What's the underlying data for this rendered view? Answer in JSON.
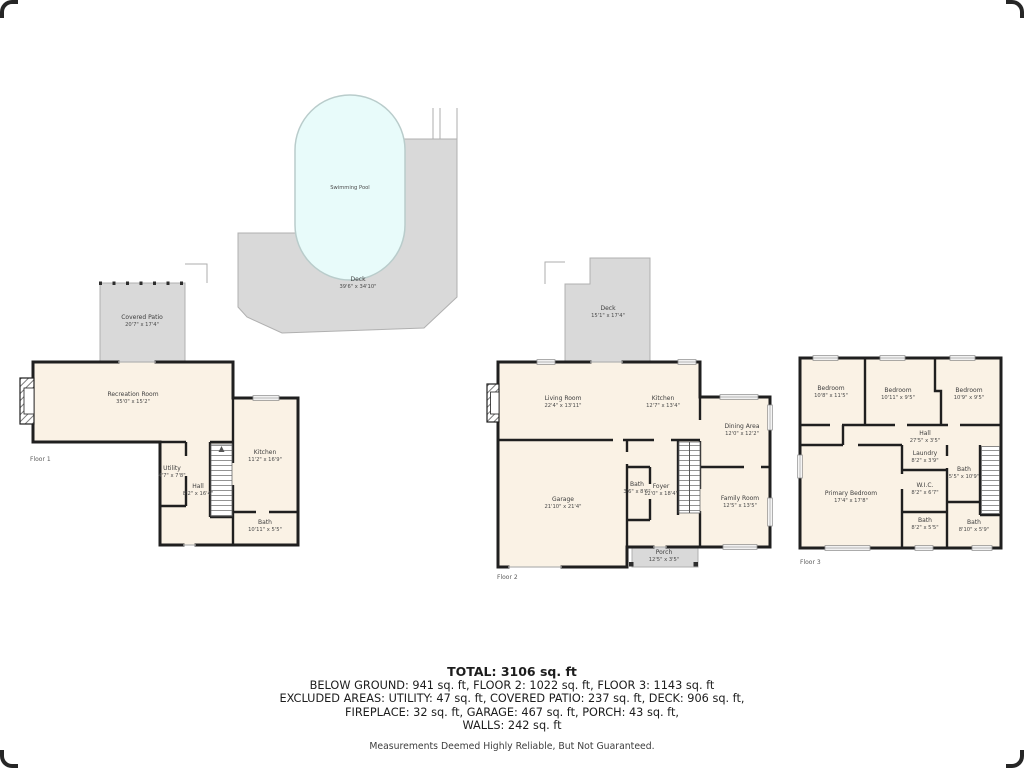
{
  "pool_area": {
    "pool": {
      "label": "Swimming Pool"
    },
    "pool_deck": {
      "name": "Deck",
      "dims": "39'6\" x 34'10\""
    },
    "covered_patio": {
      "name": "Covered Patio",
      "dims": "20'7\" x 17'4\""
    }
  },
  "floor1": {
    "label": "Floor 1",
    "rooms": {
      "recreation_room": {
        "name": "Recreation Room",
        "dims": "35'0\" x 15'2\""
      },
      "utility": {
        "name": "Utility",
        "dims": "4'7\" x 7'8\""
      },
      "hall": {
        "name": "Hall",
        "dims": "8'2\" x 16'4\""
      },
      "kitchen": {
        "name": "Kitchen",
        "dims": "11'2\" x 16'9\""
      },
      "bath": {
        "name": "Bath",
        "dims": "10'11\" x 5'5\""
      }
    }
  },
  "floor2": {
    "label": "Floor 2",
    "rooms": {
      "deck": {
        "name": "Deck",
        "dims": "15'1\" x 17'4\""
      },
      "living_room": {
        "name": "Living Room",
        "dims": "22'4\" x 13'11\""
      },
      "kitchen": {
        "name": "Kitchen",
        "dims": "12'7\" x 13'4\""
      },
      "dining_area": {
        "name": "Dining Area",
        "dims": "12'0\" x 12'2\""
      },
      "garage": {
        "name": "Garage",
        "dims": "21'10\" x 21'4\""
      },
      "bath": {
        "name": "Bath",
        "dims": "3'6\" x 8'6\""
      },
      "foyer": {
        "name": "Foyer",
        "dims": "12'0\" x 18'4\""
      },
      "family_room": {
        "name": "Family Room",
        "dims": "12'5\" x 13'5\""
      },
      "porch": {
        "name": "Porch",
        "dims": "12'5\" x 3'5\""
      }
    }
  },
  "floor3": {
    "label": "Floor 3",
    "rooms": {
      "bedroom_1": {
        "name": "Bedroom",
        "dims": "10'8\" x 11'5\""
      },
      "bedroom_2": {
        "name": "Bedroom",
        "dims": "10'11\" x 9'5\""
      },
      "bedroom_3": {
        "name": "Bedroom",
        "dims": "10'9\" x 9'5\""
      },
      "hall": {
        "name": "Hall",
        "dims": "27'5\" x 3'5\""
      },
      "laundry": {
        "name": "Laundry",
        "dims": "8'2\" x 3'9\""
      },
      "bath_upper": {
        "name": "Bath",
        "dims": "5'5\" x 10'9\""
      },
      "wic": {
        "name": "W.I.C.",
        "dims": "8'2\" x 6'7\""
      },
      "primary_bedroom": {
        "name": "Primary Bedroom",
        "dims": "17'4\" x 17'8\""
      },
      "bath_lower_mid": {
        "name": "Bath",
        "dims": "8'2\" x 5'5\""
      },
      "bath_lower_right": {
        "name": "Bath",
        "dims": "8'10\" x 5'9\""
      }
    }
  },
  "summary": {
    "total": "TOTAL: 3106 sq. ft",
    "line_floors": "BELOW GROUND: 941 sq. ft, FLOOR 2: 1022 sq. ft, FLOOR 3: 1143 sq. ft",
    "line_excluded_1": "EXCLUDED AREAS: UTILITY: 47 sq. ft, COVERED PATIO: 237 sq. ft, DECK: 906 sq. ft,",
    "line_excluded_2": "FIREPLACE: 32 sq. ft, GARAGE: 467 sq. ft, PORCH: 43 sq. ft,",
    "line_walls": "WALLS: 242 sq. ft",
    "disclaimer": "Measurements Deemed Highly Reliable, But Not Guaranteed."
  },
  "colors": {
    "room_fill": "#faf2e5",
    "outdoor_fill": "#d9d9d9",
    "pool_fill": "#e8fbfa",
    "wall": "#1f1f1f"
  }
}
